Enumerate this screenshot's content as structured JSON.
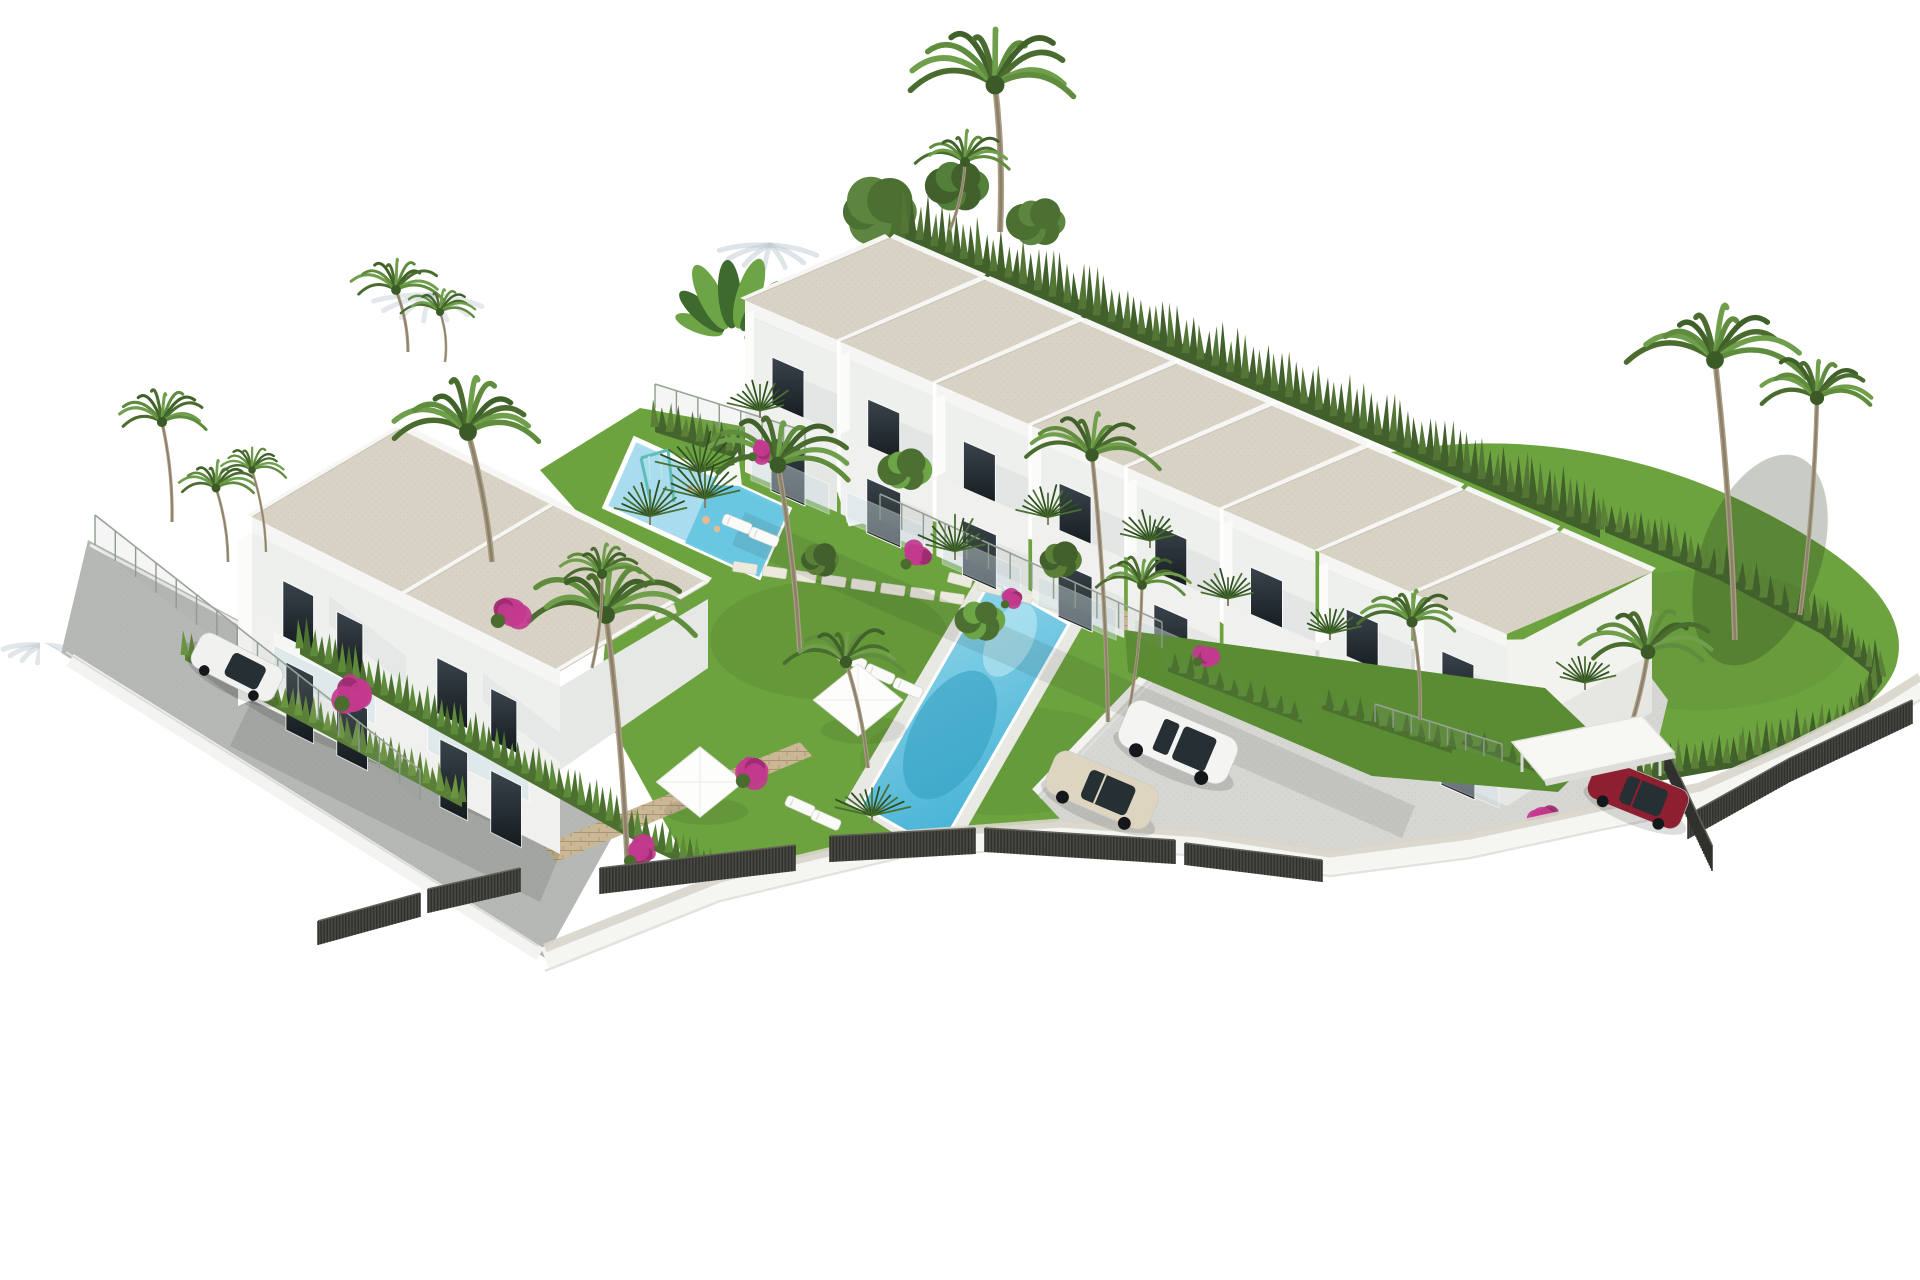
{
  "scene": {
    "description": "Aerial 3D architectural rendering of a white Mediterranean residential complex: a row of eight terraced townhouses with beige flat roofs, a two-unit villa at the left, communal lap pool with sun loungers and parasols, a kids splash pool with a swing set, palm gardens, a paved parking court with cars, perimeter walls with dark slatted fencing, all on a plain white background"
  },
  "palette": {
    "background": "#ffffff",
    "roof_beige": "#d9d3c5",
    "roof_edge": "#f6f6f4",
    "wall_white": "#f2f2ef",
    "wall_bright": "#fbfbf9",
    "wall_shade": "#e0e3e1",
    "window_dark": "#20282d",
    "lawn_green": "#6da33f",
    "lawn_dark": "#5a8c33",
    "hedge_green": "#41602c",
    "hedge_light": "#5a8038",
    "palm_dark": "#4a6c2f",
    "palm_light": "#6f9f4a",
    "pool_light": "#a8dcee",
    "pool_deep": "#3aa9cd",
    "street_gray": "#b6b8b5",
    "paving_gray": "#d6d6d3",
    "walkway_beige": "#d8d6cb",
    "fence_dark": "#4a4a44",
    "fence_line": "#30302c",
    "stone_tan": "#c9b795",
    "stone_line": "#a9956f",
    "bougainvillea": "#c23a8e",
    "bougainvillea_dark": "#9c2a6e",
    "swing_teal": "#5fbdb7",
    "shadow_blue": "#c3cdd4"
  },
  "inventory": {
    "townhouse_row": {
      "label": "terraced-townhouse-row",
      "units": 8,
      "floors": 2
    },
    "left_building": {
      "label": "two-unit-villa",
      "units": 2,
      "floors": 2
    },
    "pools": [
      {
        "label": "main-lap-pool"
      },
      {
        "label": "kids-splash-pool-with-swing-set"
      }
    ],
    "cars": [
      {
        "label": "white-suv",
        "color": "#f4f4f2"
      },
      {
        "label": "beige-sedan",
        "color": "#ddd5c0"
      },
      {
        "label": "white-hatchback",
        "color": "#f1f1ef"
      },
      {
        "label": "red-car",
        "color": "#8e1f31"
      }
    ],
    "palms_feather": 18,
    "palms_fan": 11,
    "sun_loungers": 7,
    "parasols": 2,
    "swing_sets": 1
  }
}
